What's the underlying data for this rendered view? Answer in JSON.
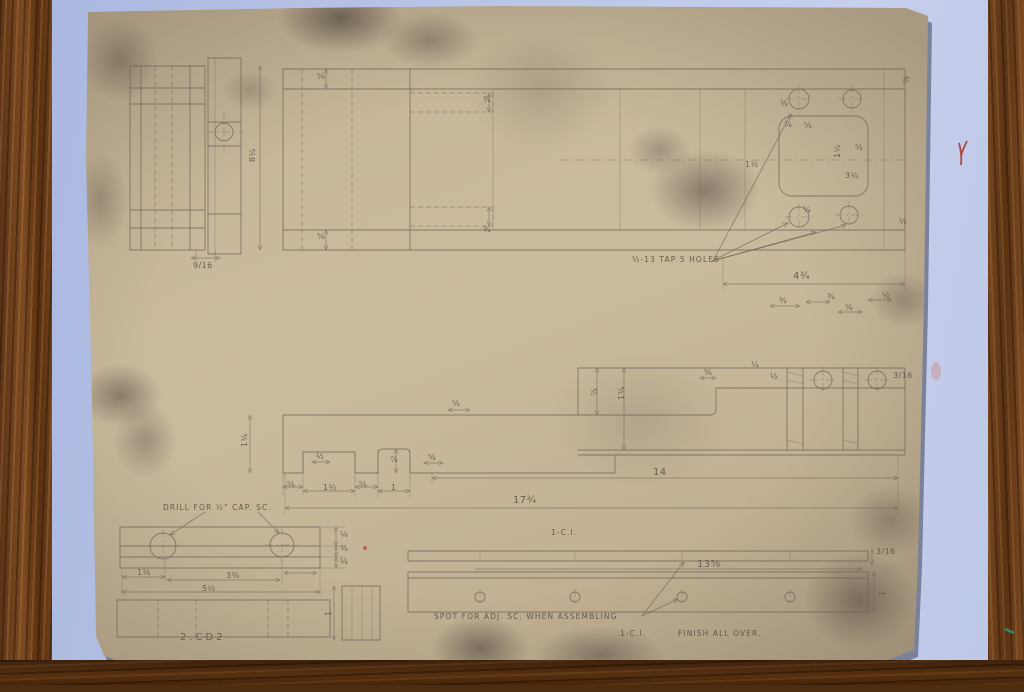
{
  "colors": {
    "mat": "#b5c1e4",
    "paper_base": "#c8b79a",
    "wood_light": "#7c4a22",
    "wood_dark": "#4e2c10",
    "pencil": "#6e6457",
    "red_mark": "#a8322a",
    "teal_mark": "#2a8f85"
  },
  "notes": {
    "tap_note": "½-13 TAP  5 HOLES",
    "drill_note": "DRILL FOR ½\" CAP. SC.",
    "spot_note": "SPOT FOR ADJ. SC. WHEN ASSEMBLING",
    "plate_material_label": "1-C.I.",
    "finish_material_label": "1-C.I.",
    "finish_note": "FINISH ALL OVER.",
    "sheet_number": "2.CD2"
  },
  "dims": [
    "⅝",
    "¾",
    "⅜",
    "⅞",
    "⅝",
    "1½",
    "1¼",
    "⅝",
    "3¼",
    "¼",
    "⅞",
    "½",
    "8¼",
    "⅝",
    "¾",
    "9/16",
    "4¾",
    "¾",
    "¾",
    "⅝",
    "½",
    "⅞",
    "1¼",
    "⅝",
    "¼",
    "½",
    "3/16",
    "1¼",
    "⅝",
    "½",
    "⅞",
    "⅝",
    "⅝",
    "1½",
    "⅝",
    "1",
    "14",
    "17¾",
    "⅛",
    "⅜",
    "⅛",
    "1⅛",
    "3⅜",
    "5½",
    "1",
    "13⅝",
    "3/16",
    "1"
  ]
}
